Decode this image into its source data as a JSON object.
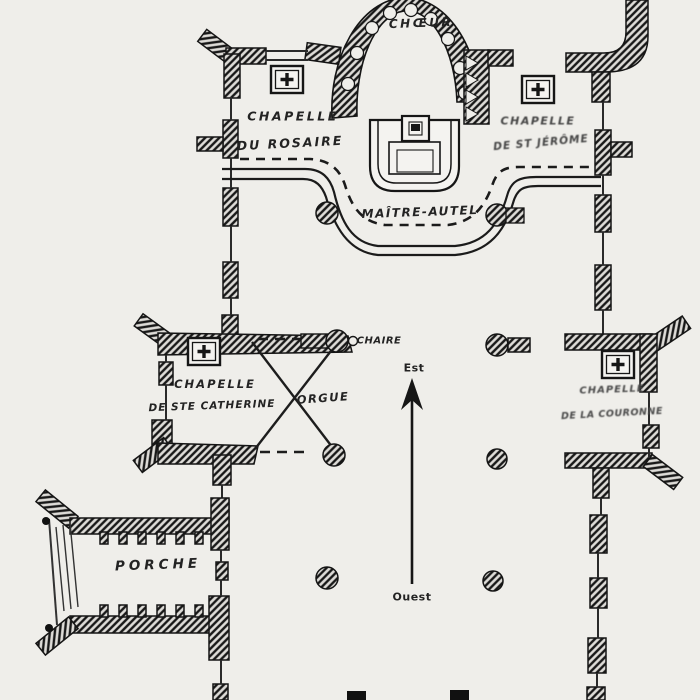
{
  "document": {
    "type": "church-floor-plan",
    "style": "scanned engraving",
    "colors": {
      "paper": "#efeeea",
      "ink": "#1b1b1b",
      "wall_hatch_bg": "#dedcd8"
    }
  },
  "labels": {
    "choeur": "CHŒUR",
    "chapelle_rosaire_line1": "CHAPELLE",
    "chapelle_rosaire_line2": "DU ROSAIRE",
    "chapelle_jerome_line1": "CHAPELLE",
    "chapelle_jerome_line2": "DE ST JÉRÔME",
    "maitre_autel": "MAÎTRE-AUTEL",
    "chaire": "CHAIRE",
    "orgue": "ORGUE",
    "chapelle_catherine_line1": "CHAPELLE",
    "chapelle_catherine_line2": "DE STE CATHERINE",
    "chapelle_couronne_line1": "CHAPELLE",
    "chapelle_couronne_line2": "DE LA COURONNE",
    "porche": "PORCHE",
    "compass_est": "Est",
    "compass_ouest": "Ouest"
  },
  "icons": {
    "altar": "square-with-cross (autel)",
    "compass_arrow": "vertical-arrow-pointing-east(up)",
    "column": "hatched-circle-pillar",
    "legend_swatch": "solid-black-square (cut off at page bottom)"
  }
}
